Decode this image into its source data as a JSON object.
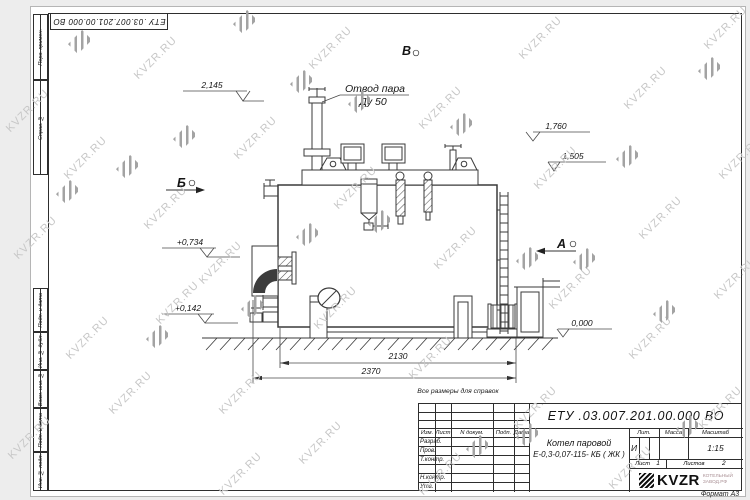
{
  "sheet": {
    "top_stamp": "ЕТУ .03.007.201.00.000  ВО",
    "format_note": "Формат А3",
    "reference_note": "Все размеры для справок",
    "side_labels": {
      "perv": "Перв. примен.",
      "sprav": "Справ. №",
      "podp1": "Подп. и дата",
      "inv_dubl": "Инв. № дубл.",
      "vzam": "Взам. инв. №",
      "podp2": "Подп. и дата",
      "inv_podl": "Инв. № подл."
    }
  },
  "drawing": {
    "labels": {
      "steam_outlet_line1": "Отвод пара",
      "steam_outlet_line2": "Ду 50"
    },
    "views": {
      "b": "Б",
      "a": "А",
      "v": "В"
    },
    "elevations": {
      "e2145": "2,145",
      "e1760": "1,760",
      "e1505": "1,505",
      "e0734": "+0,734",
      "e0142": "+0,142",
      "e0000": "0,000"
    },
    "dimensions": {
      "d2130": "2130",
      "d2370": "2370"
    }
  },
  "titleblock": {
    "designation": "ЕТУ .03.007.201.00.000  ВО",
    "doc_name_line1": "Котел паровой",
    "doc_name_line2": "Е-0,3-0,07-115- КБ ( ЖК )",
    "cols": {
      "izm": "Изм.",
      "list": "Лист",
      "ndocum": "N докум.",
      "podp": "Подп.",
      "data": "Дата"
    },
    "rows": {
      "razrab": "Разраб.",
      "prov": "Пров.",
      "tkontr": "Т.контр.",
      "nkontr": "Н.контр.",
      "utv": "Утв."
    },
    "lit_header": "Лит.",
    "mass_header": "Масса",
    "scale_header": "Масштаб",
    "lit_value": "И",
    "scale_value": "1:15",
    "sheet_label": "Лист",
    "sheet_value": "1",
    "sheets_label": "Листов",
    "sheets_value": "2",
    "logo_text": "KVZR",
    "logo_sub1": "КОТЕЛЬНЫЙ",
    "logo_sub2": "ЗАВОД.РФ"
  },
  "watermark": {
    "text": "KVZR.RU"
  },
  "colors": {
    "line": "#3a3a3a",
    "watermark_text": "#c7c7c7",
    "logo_black": "#111111"
  }
}
